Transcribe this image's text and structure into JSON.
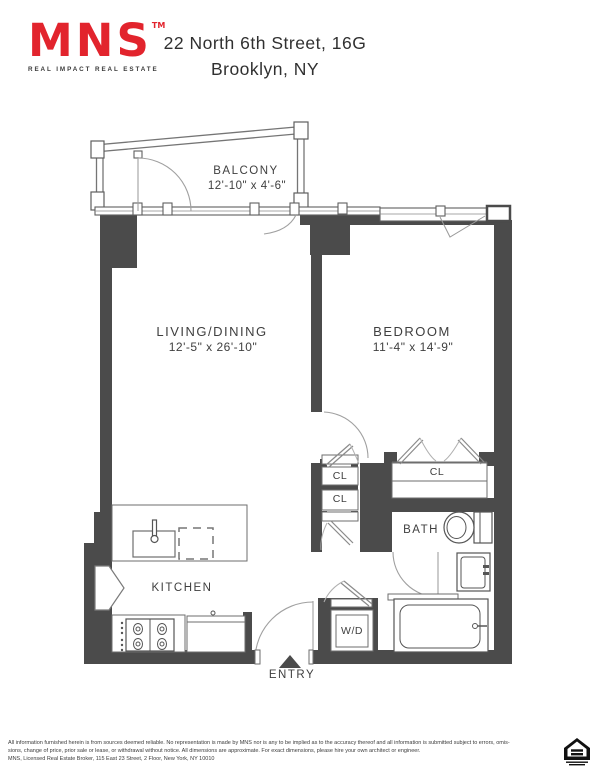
{
  "header": {
    "logo_text": "MNS",
    "logo_tm": "TM",
    "logo_tagline": "REAL IMPACT REAL ESTATE",
    "title_line1": "22 North 6th Street, 16G",
    "title_line2": "Brooklyn, NY"
  },
  "colors": {
    "brand_red": "#e2242d",
    "wall_gray": "#4b4b4b",
    "label_gray": "#3f3f3f"
  },
  "rooms": {
    "balcony": {
      "label": "BALCONY",
      "dims": "12'-10\" x 4'-6\""
    },
    "living_dining": {
      "label": "LIVING/DINING",
      "dims": "12'-5\" x 26'-10\""
    },
    "bedroom": {
      "label": "BEDROOM",
      "dims": "11'-4\" x 14'-9\""
    },
    "kitchen": {
      "label": "KITCHEN"
    },
    "bath": {
      "label": "BATH"
    },
    "entry": {
      "label": "ENTRY"
    },
    "washer_dryer": {
      "label": "W/D"
    },
    "closet_hall_1": {
      "label": "CL"
    },
    "closet_hall_2": {
      "label": "CL"
    },
    "closet_bedroom": {
      "label": "CL"
    }
  },
  "footer": {
    "disclaimer_line1": "All information furnished herein is from sources deemed reliable. No representation is made by MNS nor is any to be implied as to the accuracy thereof and all information is submitted subject to errors, omis-",
    "disclaimer_line2": "sions, change of price, prior sale or lease, or withdrawal without notice. All dimensions are approximate. For exact dimensions, please hire your own architect or engineer.",
    "broker_line": "MNS, Licensed Real Estate Broker, 115 East 23 Street, 2 Floor, New York, NY 10010",
    "equal_housing_icon": "equal-housing-opportunity"
  }
}
